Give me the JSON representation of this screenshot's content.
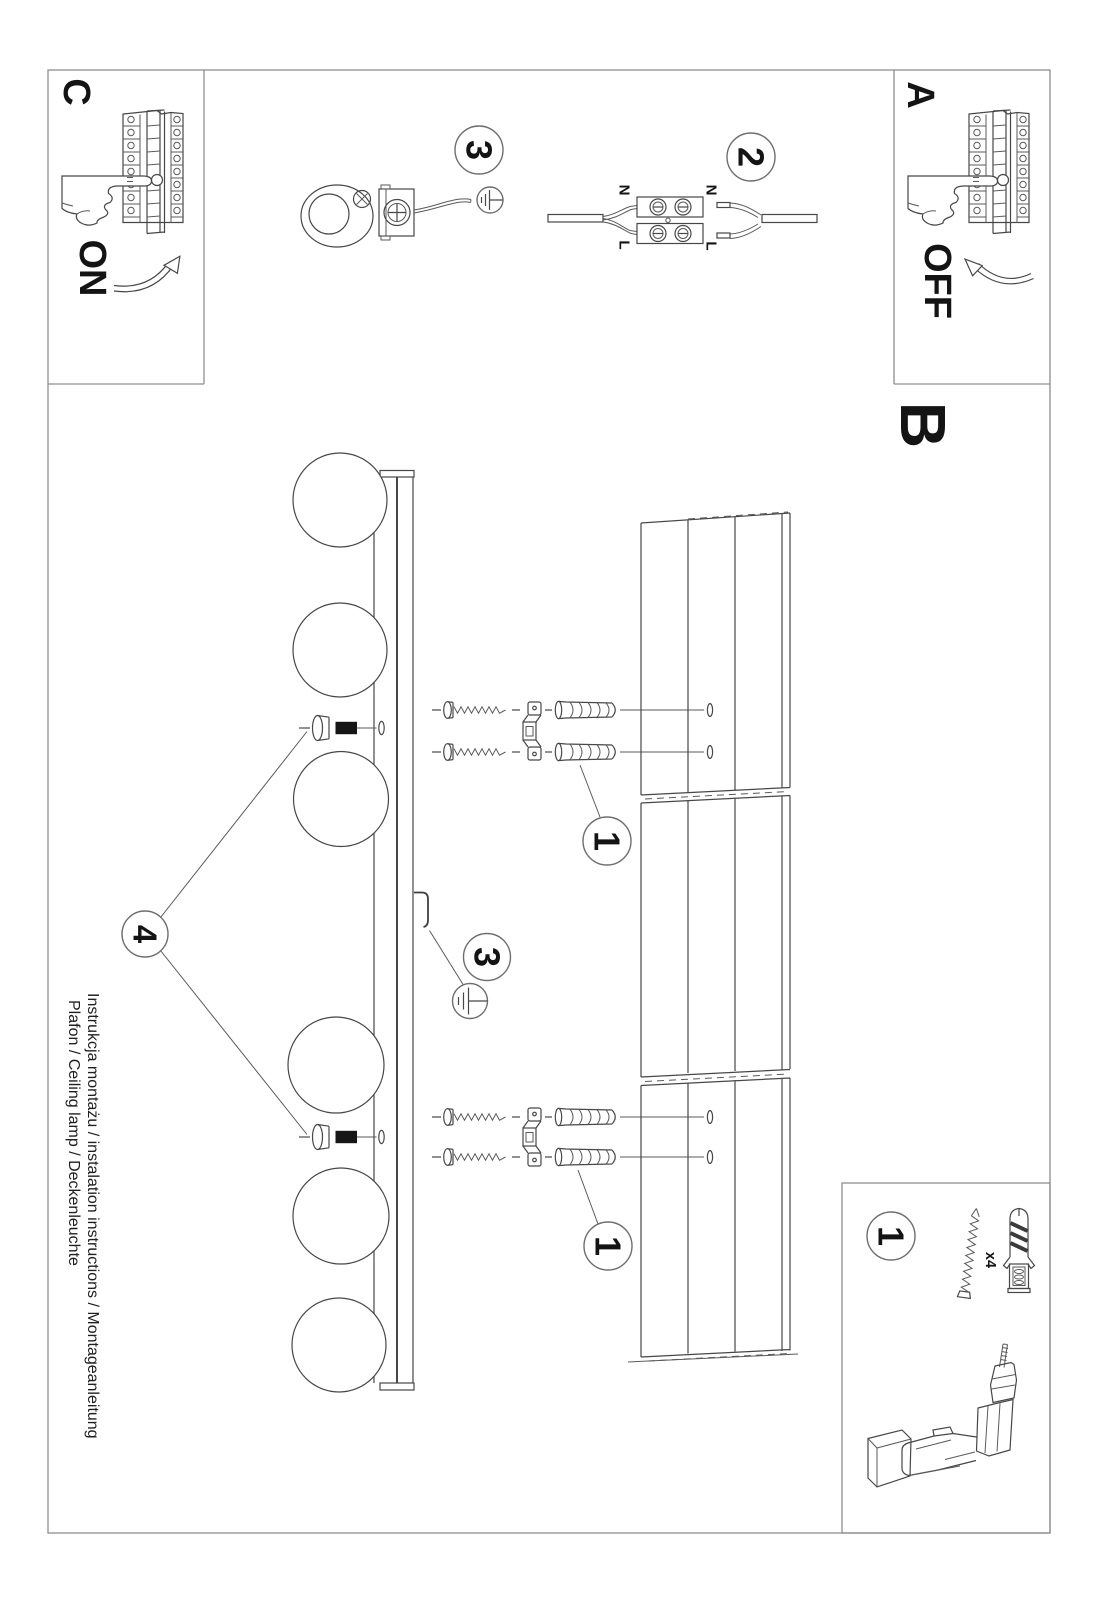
{
  "page": {
    "panels": {
      "c": {
        "label": "C",
        "state": "ON"
      },
      "a": {
        "label": "A",
        "state": "OFF"
      },
      "b": {
        "label": "B"
      }
    },
    "steps": {
      "s1": "1",
      "s2": "2",
      "s3": "3",
      "s4": "4"
    },
    "wiring": {
      "left_n": "N",
      "left_l": "L",
      "right_n": "N",
      "right_l": "L"
    },
    "parts_legend": {
      "step": "1",
      "qty": "x4"
    },
    "title_block": {
      "line1": "Instrukcja montażu / instalation instructions / Montageanleitung",
      "line2": "Plafon / Ceiling lamp / Deckenleuchte"
    },
    "colors": {
      "ink": "#474747",
      "frame": "#8f8f8f",
      "text": "#141414"
    }
  }
}
